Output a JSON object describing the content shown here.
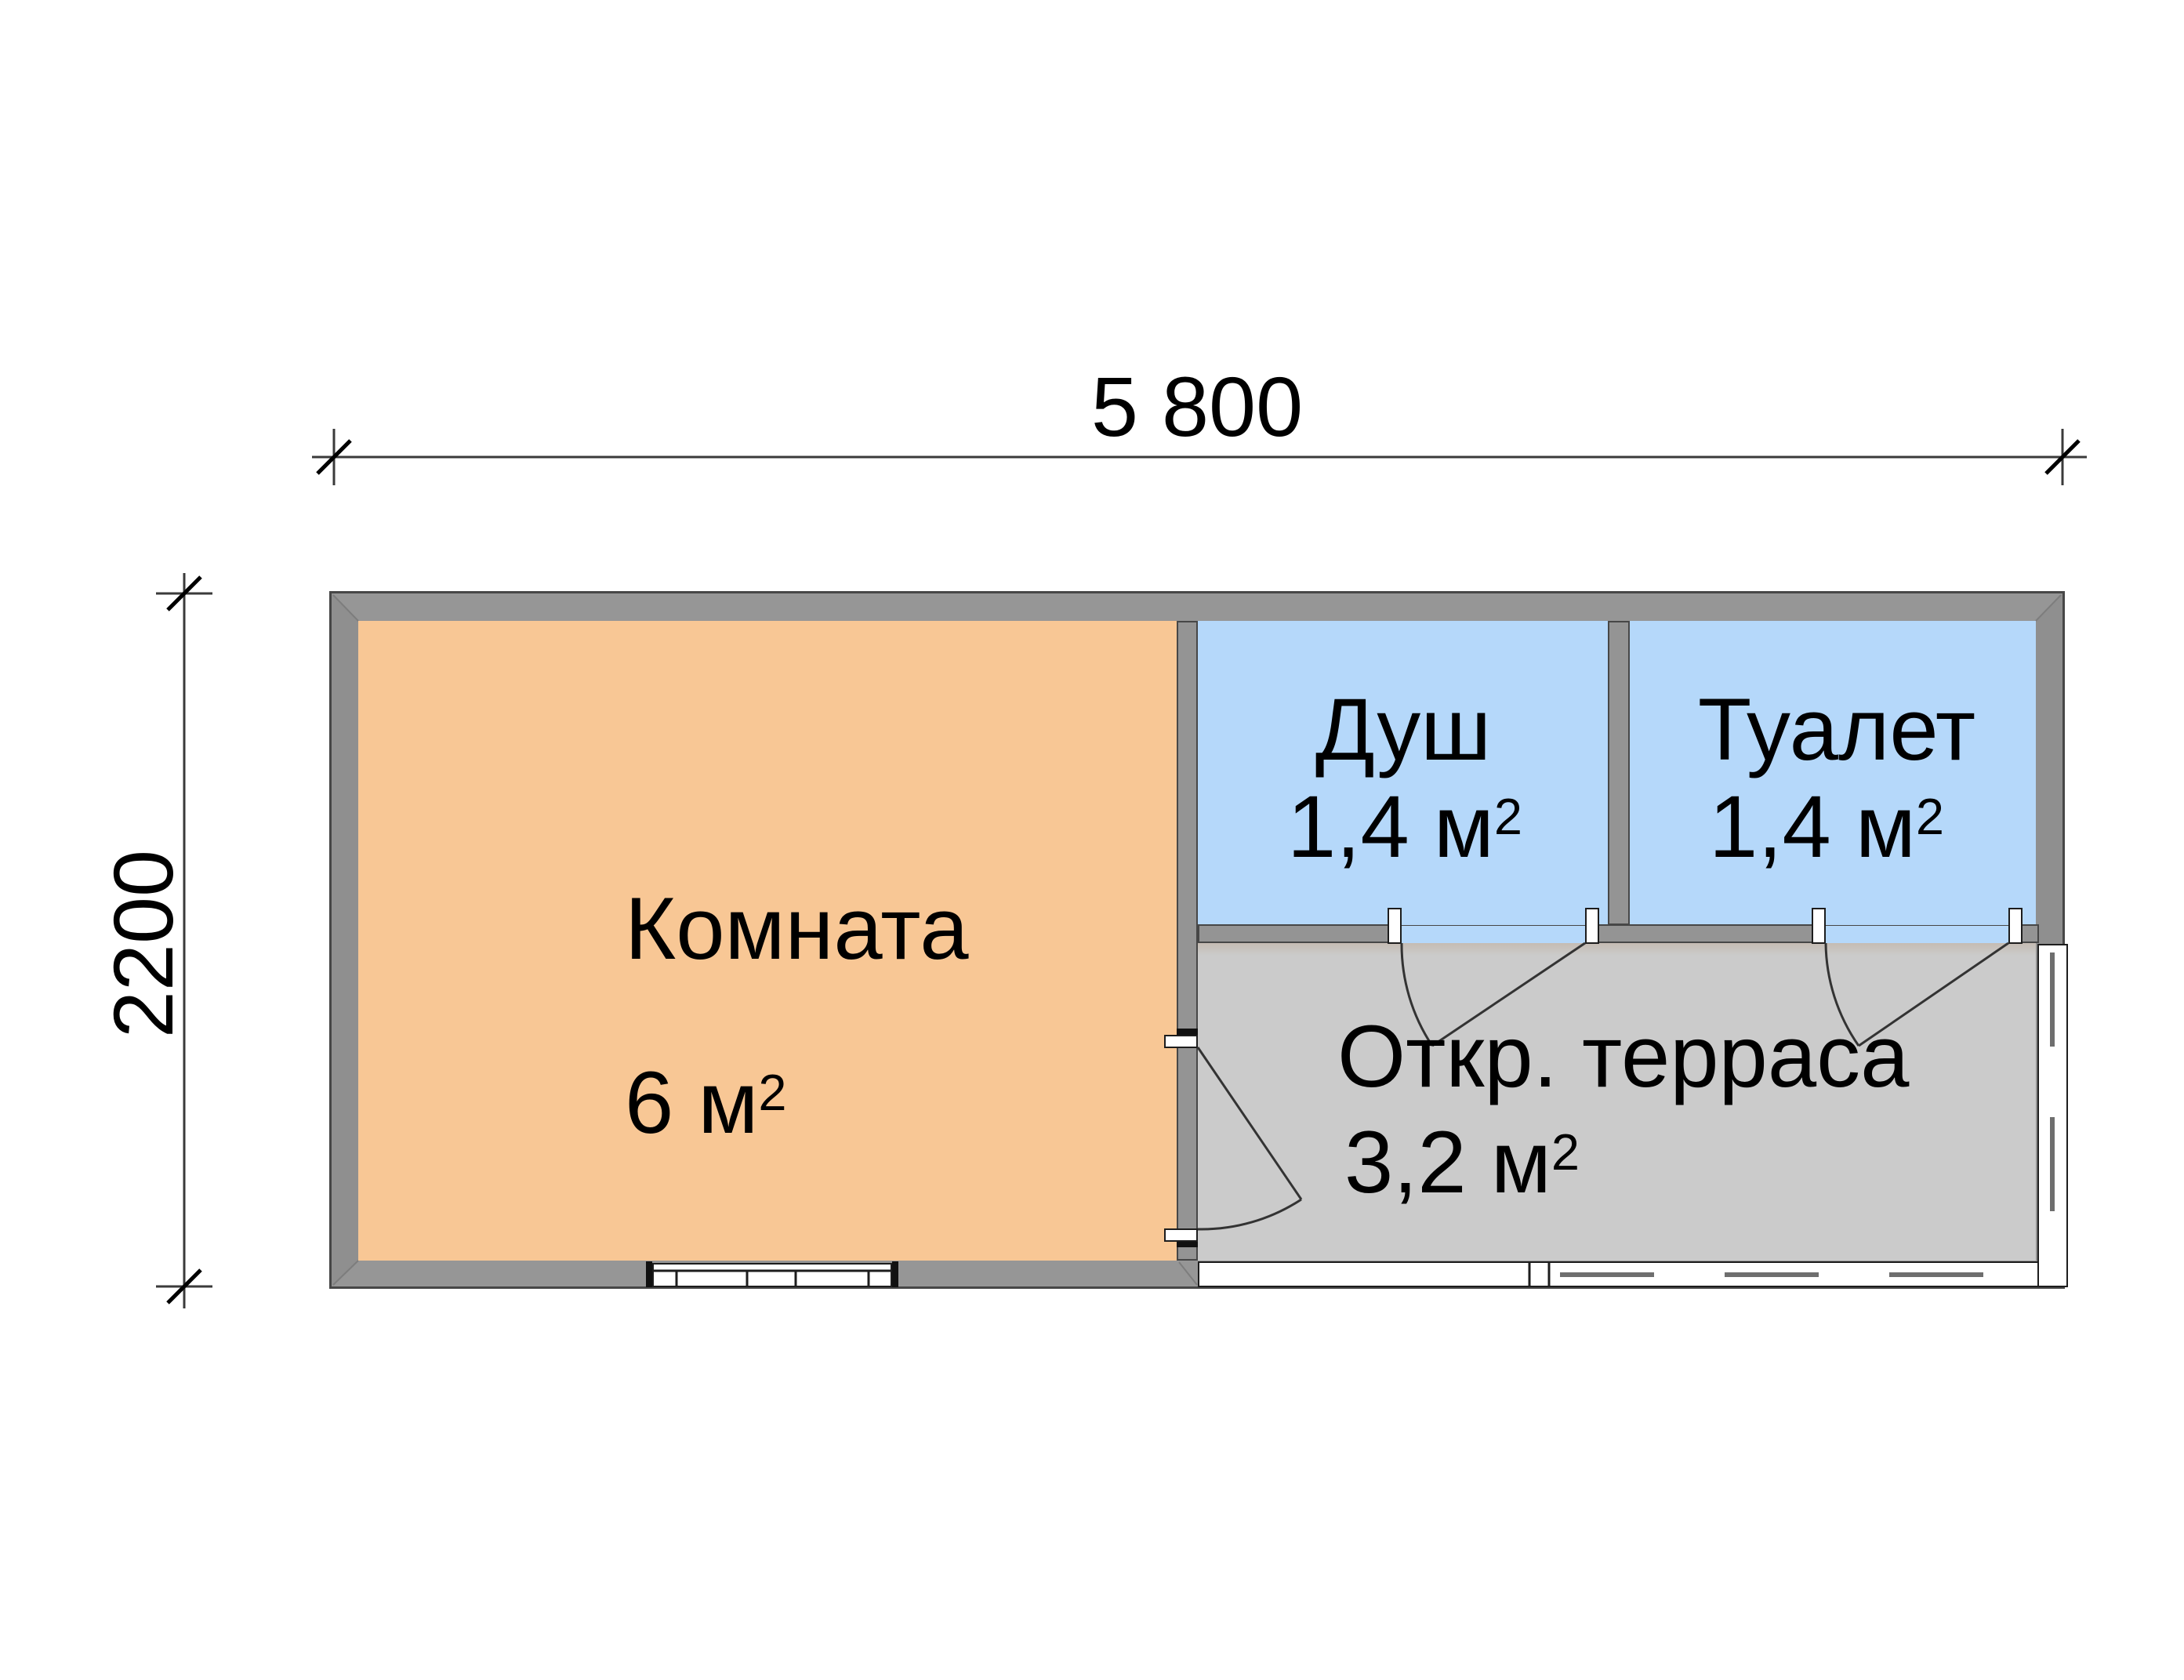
{
  "plan": {
    "title_hidden": "",
    "dimensions": {
      "top_label": "5 800",
      "left_label": "2200"
    },
    "rooms": {
      "room": {
        "name": "Комната",
        "area_base": "6 м",
        "area_sup": "2"
      },
      "shower": {
        "name": "Душ",
        "area_base": "1,4 м",
        "area_sup": "2"
      },
      "toilet": {
        "name": "Туалет",
        "area_base": "1,4 м",
        "area_sup": "2"
      },
      "terrace": {
        "name": "Откр. терраса",
        "area_base": "3,2 м",
        "area_sup": "2"
      }
    },
    "colors": {
      "room_fill": "#F8C795",
      "wet_room_fill": "#B5D8FA",
      "terrace_fill": "#CBCBCB",
      "wall_fill": "#949494",
      "outline": "#474747",
      "line_dark": "#1d1d1d",
      "dim_line": "#3a3a3a"
    }
  }
}
